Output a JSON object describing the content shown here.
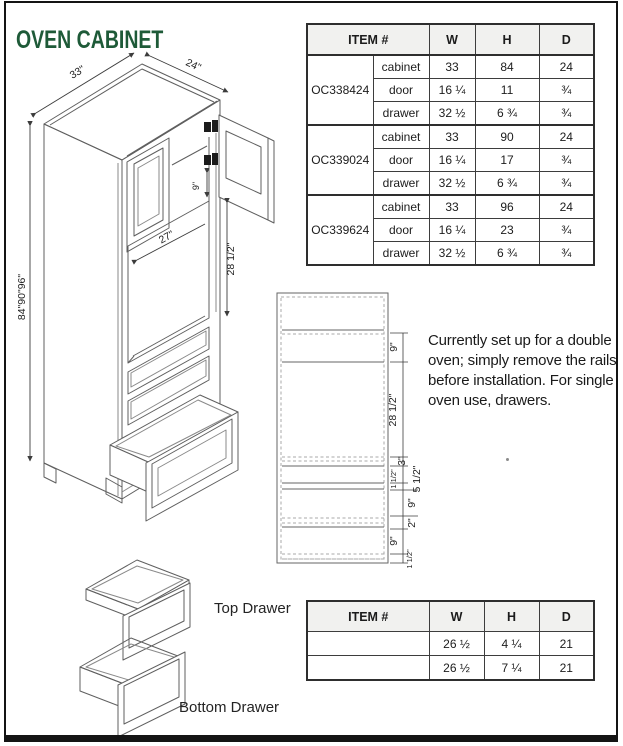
{
  "page": {
    "title": "OVEN CABINET"
  },
  "colors": {
    "title": "#1e5a38",
    "line": "#5f5f5f",
    "dim_text": "#222222"
  },
  "spec_table": {
    "headers": {
      "item": "ITEM #",
      "w": "W",
      "h": "H",
      "d": "D"
    },
    "groups": [
      {
        "item": "OC338424",
        "rows": [
          {
            "part": "cabinet",
            "w": "33",
            "h": "84",
            "d": "24"
          },
          {
            "part": "door",
            "w": "16 ¼",
            "h": "11",
            "d": "¾"
          },
          {
            "part": "drawer",
            "w": "32 ½",
            "h": "6 ¾",
            "d": "¾"
          }
        ]
      },
      {
        "item": "OC339024",
        "rows": [
          {
            "part": "cabinet",
            "w": "33",
            "h": "90",
            "d": "24"
          },
          {
            "part": "door",
            "w": "16 ¼",
            "h": "17",
            "d": "¾"
          },
          {
            "part": "drawer",
            "w": "32 ½",
            "h": "6 ¾",
            "d": "¾"
          }
        ]
      },
      {
        "item": "OC339624",
        "rows": [
          {
            "part": "cabinet",
            "w": "33",
            "h": "96",
            "d": "24"
          },
          {
            "part": "door",
            "w": "16 ¼",
            "h": "23",
            "d": "¾"
          },
          {
            "part": "drawer",
            "w": "32 ½",
            "h": "6 ¾",
            "d": "¾"
          }
        ]
      }
    ]
  },
  "drawer_table": {
    "headers": {
      "item": "ITEM #",
      "w": "W",
      "h": "H",
      "d": "D"
    },
    "rows": [
      {
        "item": "",
        "w": "26 ½",
        "h": "4 ¼",
        "d": "21"
      },
      {
        "item": "",
        "w": "26 ½",
        "h": "7 ¼",
        "d": "21"
      }
    ]
  },
  "note": {
    "text": "Currently set up for a double\noven; simply remove the rails\nbefore installation. For single\noven use, drawers."
  },
  "iso": {
    "width": "33\"",
    "depth": "24\"",
    "heights": "84\"90\"96\"",
    "rail": "9\"",
    "opening_width": "27\"",
    "opening_height": "28 1/2\""
  },
  "elevation": {
    "dims": [
      "9\"",
      "28 1/2\"",
      "3\"",
      "1 1/2\"",
      "5 1/2\"",
      "9\"",
      "2\"",
      "9\"",
      "1 1/2\""
    ]
  },
  "drawers": {
    "top_label": "Top Drawer",
    "bottom_label": "Bottom Drawer"
  }
}
